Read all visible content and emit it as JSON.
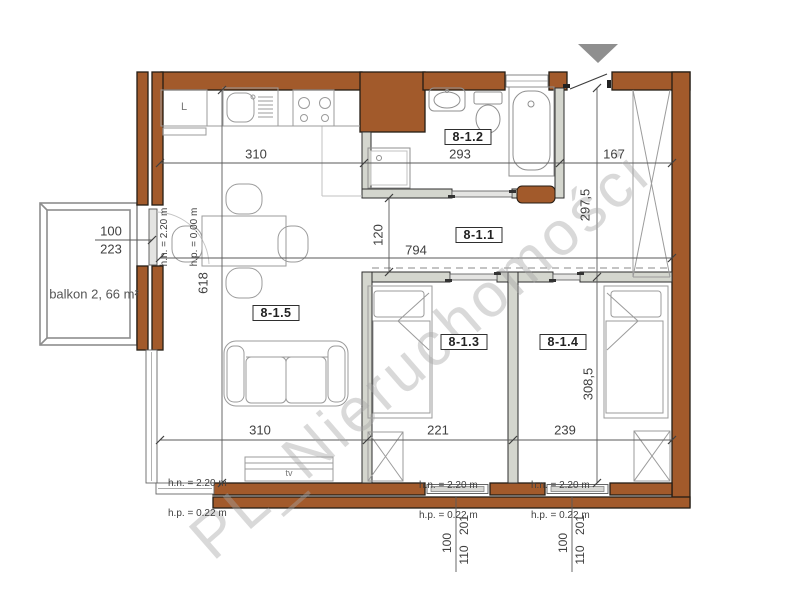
{
  "watermark": "PL_Nieruchomości",
  "rooms": {
    "hall": "8-1.1",
    "bathroom": "8-1.2",
    "bedroom1": "8-1.3",
    "bedroom2": "8-1.4",
    "living": "8-1.5"
  },
  "balcony": {
    "label": "balkon 2, 66 m²",
    "door_width": "100",
    "door_height": "223"
  },
  "dim": {
    "kitchen_width": "310",
    "bathroom_width": "293",
    "entry_width": "167",
    "interior_width": "794",
    "living_width": "310",
    "bedroom1_width": "221",
    "bedroom2_width": "239",
    "living_height": "618",
    "hall_height": "120",
    "entry_height": "297,5",
    "bedrooms_height": "308,5"
  },
  "windows": [
    {
      "width": "100",
      "height": "110",
      "sill": "201"
    },
    {
      "width": "100",
      "height": "110",
      "sill": "201"
    }
  ],
  "heights": {
    "living": {
      "hn": "h.n. = 2.20 m",
      "hp": "h.p. = 0.22 m"
    },
    "bedroom1": {
      "hn": "h.n. = 2.20 m",
      "hp": "h.p. = 0.22 m"
    },
    "bedroom2": {
      "hn": "h.n. = 2.20 m",
      "hp": "h.p. = 0.22 m"
    },
    "balcony_door": {
      "hn": "h.n. = 2.20 m",
      "hp": "h.p. = 0.00 m"
    }
  },
  "labels": {
    "fridge": "L",
    "tv": "tv"
  }
}
